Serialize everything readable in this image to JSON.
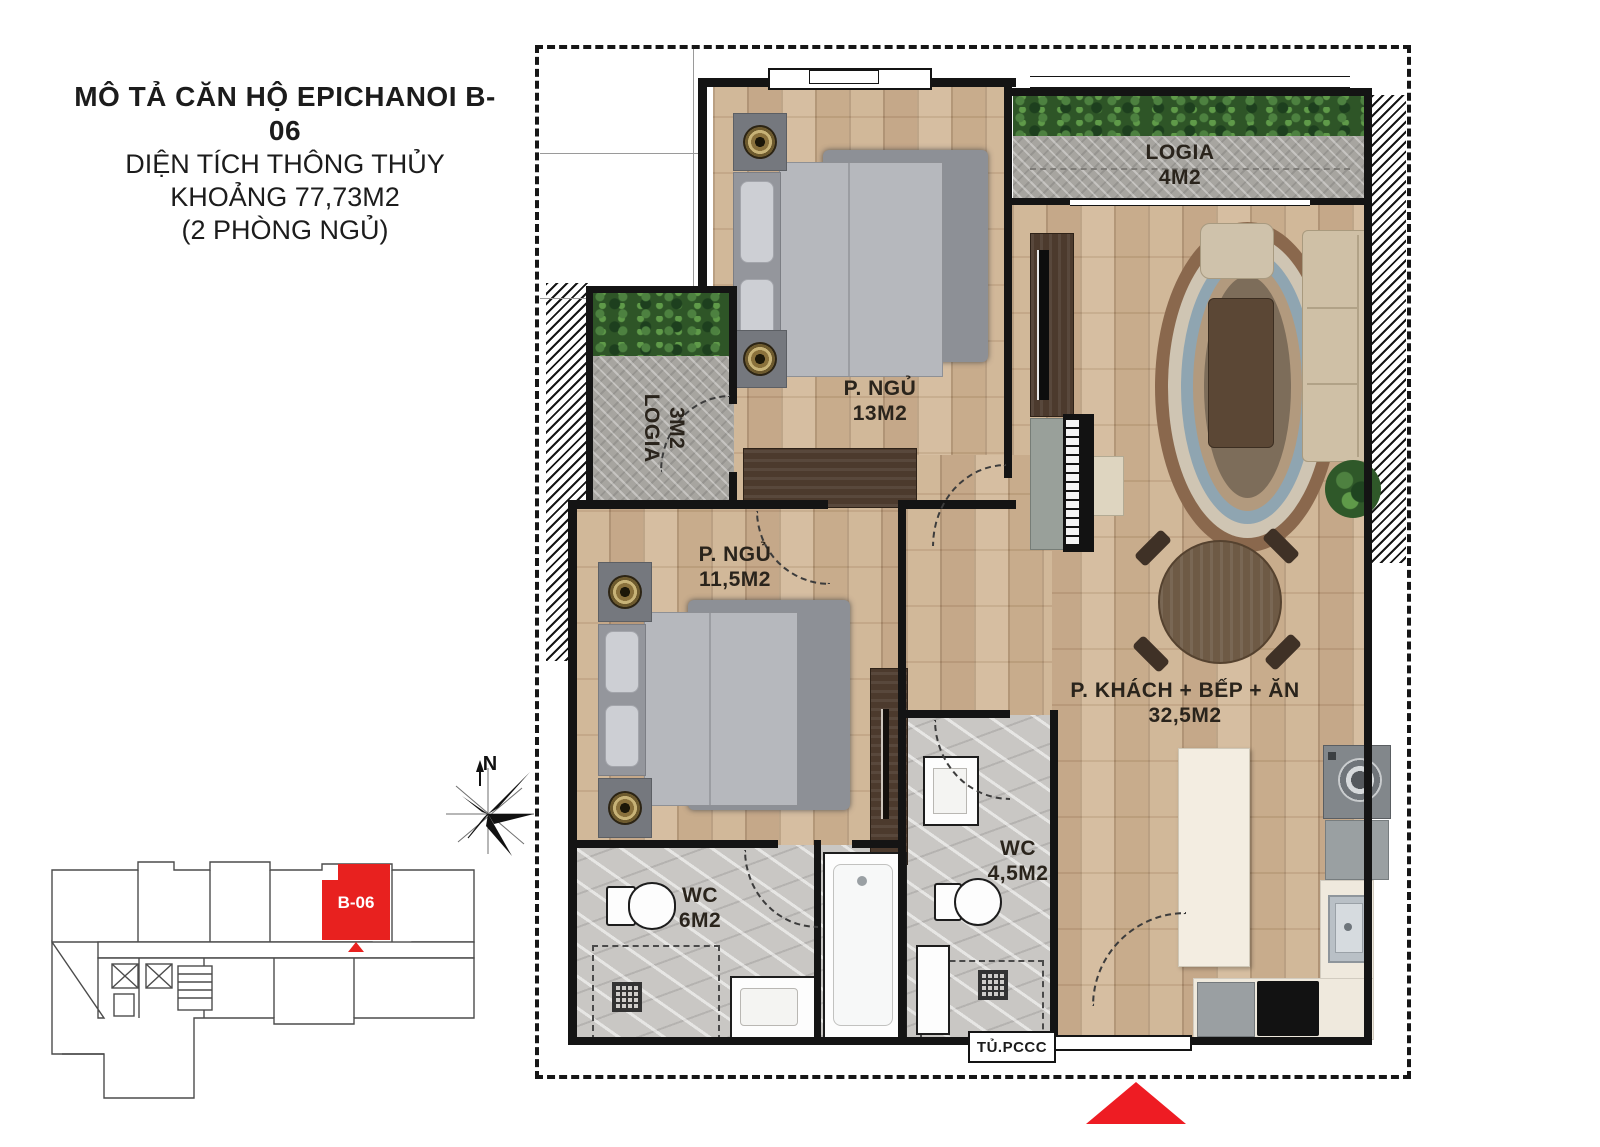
{
  "title": {
    "line1": "MÔ TẢ CĂN HỘ EPICHANOI B-06",
    "line2": "DIỆN TÍCH THÔNG THỦY",
    "line3": "KHOẢNG 77,73M2",
    "line4": "(2 PHÒNG NGỦ)"
  },
  "rooms": {
    "logia4": {
      "name": "LOGIA",
      "area": "4M2"
    },
    "logia3": {
      "name": "LOGIA",
      "area": "3M2"
    },
    "bedroom1": {
      "name": "P. NGỦ",
      "area": "13M2"
    },
    "bedroom2": {
      "name": "P. NGỦ",
      "area": "11,5M2"
    },
    "living": {
      "name": "P. KHÁCH + BẾP + ĂN",
      "area": "32,5M2"
    },
    "wc1": {
      "name": "WC",
      "area": "6M2"
    },
    "wc2": {
      "name": "WC",
      "area": "4,5M2"
    }
  },
  "labels": {
    "fire_cabinet": "TỦ.PCCC",
    "unit": "B-06",
    "compass_north": "N"
  },
  "colors": {
    "accent_red": "#e8211f",
    "wood_floor": "#c9ad8e",
    "logia_tile": "#a7a5a0",
    "wc_marble": "#c9c7c4",
    "wall": "#141414",
    "plant_green": "#2e5527"
  }
}
